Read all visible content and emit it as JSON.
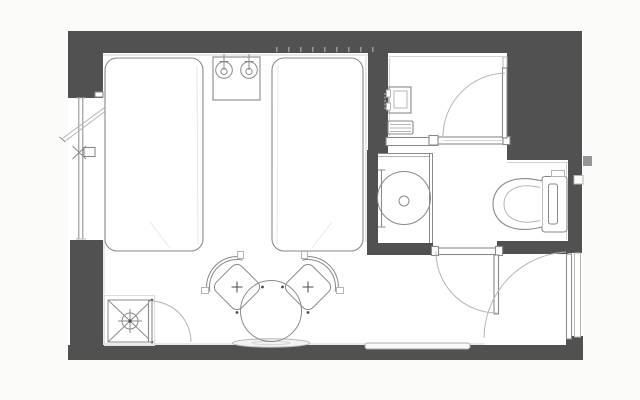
{
  "title": "Hotel twin room floor plan",
  "drawing_type": "architectural floor plan, top view, no text labels",
  "colors": {
    "wall": "#515151",
    "line": "#8a8a8a",
    "line_light": "#b5b5b5",
    "floor": "#ffffff",
    "page": "#fbfbfa",
    "ledge_fill": "#f2f2f0"
  },
  "rooms": [
    {
      "id": "bedroom",
      "label": "bedroom with twin beds"
    },
    {
      "id": "entry-closet",
      "label": "entry / closet room (top right)"
    },
    {
      "id": "shower-room",
      "label": "shower stall with round basin"
    },
    {
      "id": "wc",
      "label": "toilet area"
    }
  ],
  "fixtures": [
    {
      "id": "bed-left",
      "label": "twin bed (left)"
    },
    {
      "id": "bed-right",
      "label": "twin bed (right)"
    },
    {
      "id": "nightstand",
      "label": "nightstand between beds"
    },
    {
      "id": "reading-lamp-left",
      "label": "wall lamp symbol"
    },
    {
      "id": "reading-lamp-right",
      "label": "wall lamp symbol"
    },
    {
      "id": "lounge-chair-left",
      "label": "round-back chair"
    },
    {
      "id": "lounge-chair-right",
      "label": "round-back chair"
    },
    {
      "id": "round-table",
      "label": "round table"
    },
    {
      "id": "wall-ledge",
      "label": "flat ledge / tray at wall"
    },
    {
      "id": "luggage-rack",
      "label": "crossed-square stand with crosshair"
    },
    {
      "id": "cabinet-door",
      "label": "door swing at luggage corner"
    },
    {
      "id": "window",
      "label": "full-height window with open casement"
    },
    {
      "id": "window-handle",
      "label": "window handle with X mark"
    },
    {
      "id": "wall-panel",
      "label": "wall-mounted panel in entry"
    },
    {
      "id": "step-box",
      "label": "low box / step in entry"
    },
    {
      "id": "entry-room-door",
      "label": "swing door of entry room"
    },
    {
      "id": "shower-basin",
      "label": "round shower basin with drain"
    },
    {
      "id": "shower-glass",
      "label": "glass partition"
    },
    {
      "id": "grab-rail",
      "label": "rail on shower wall"
    },
    {
      "id": "toilet",
      "label": "toilet with tank"
    },
    {
      "id": "bathroom-door",
      "label": "swing door to bathroom corridor"
    },
    {
      "id": "entrance-door",
      "label": "room entrance door in right wall"
    },
    {
      "id": "threshold-strip",
      "label": "threshold strip on bottom wall"
    }
  ]
}
